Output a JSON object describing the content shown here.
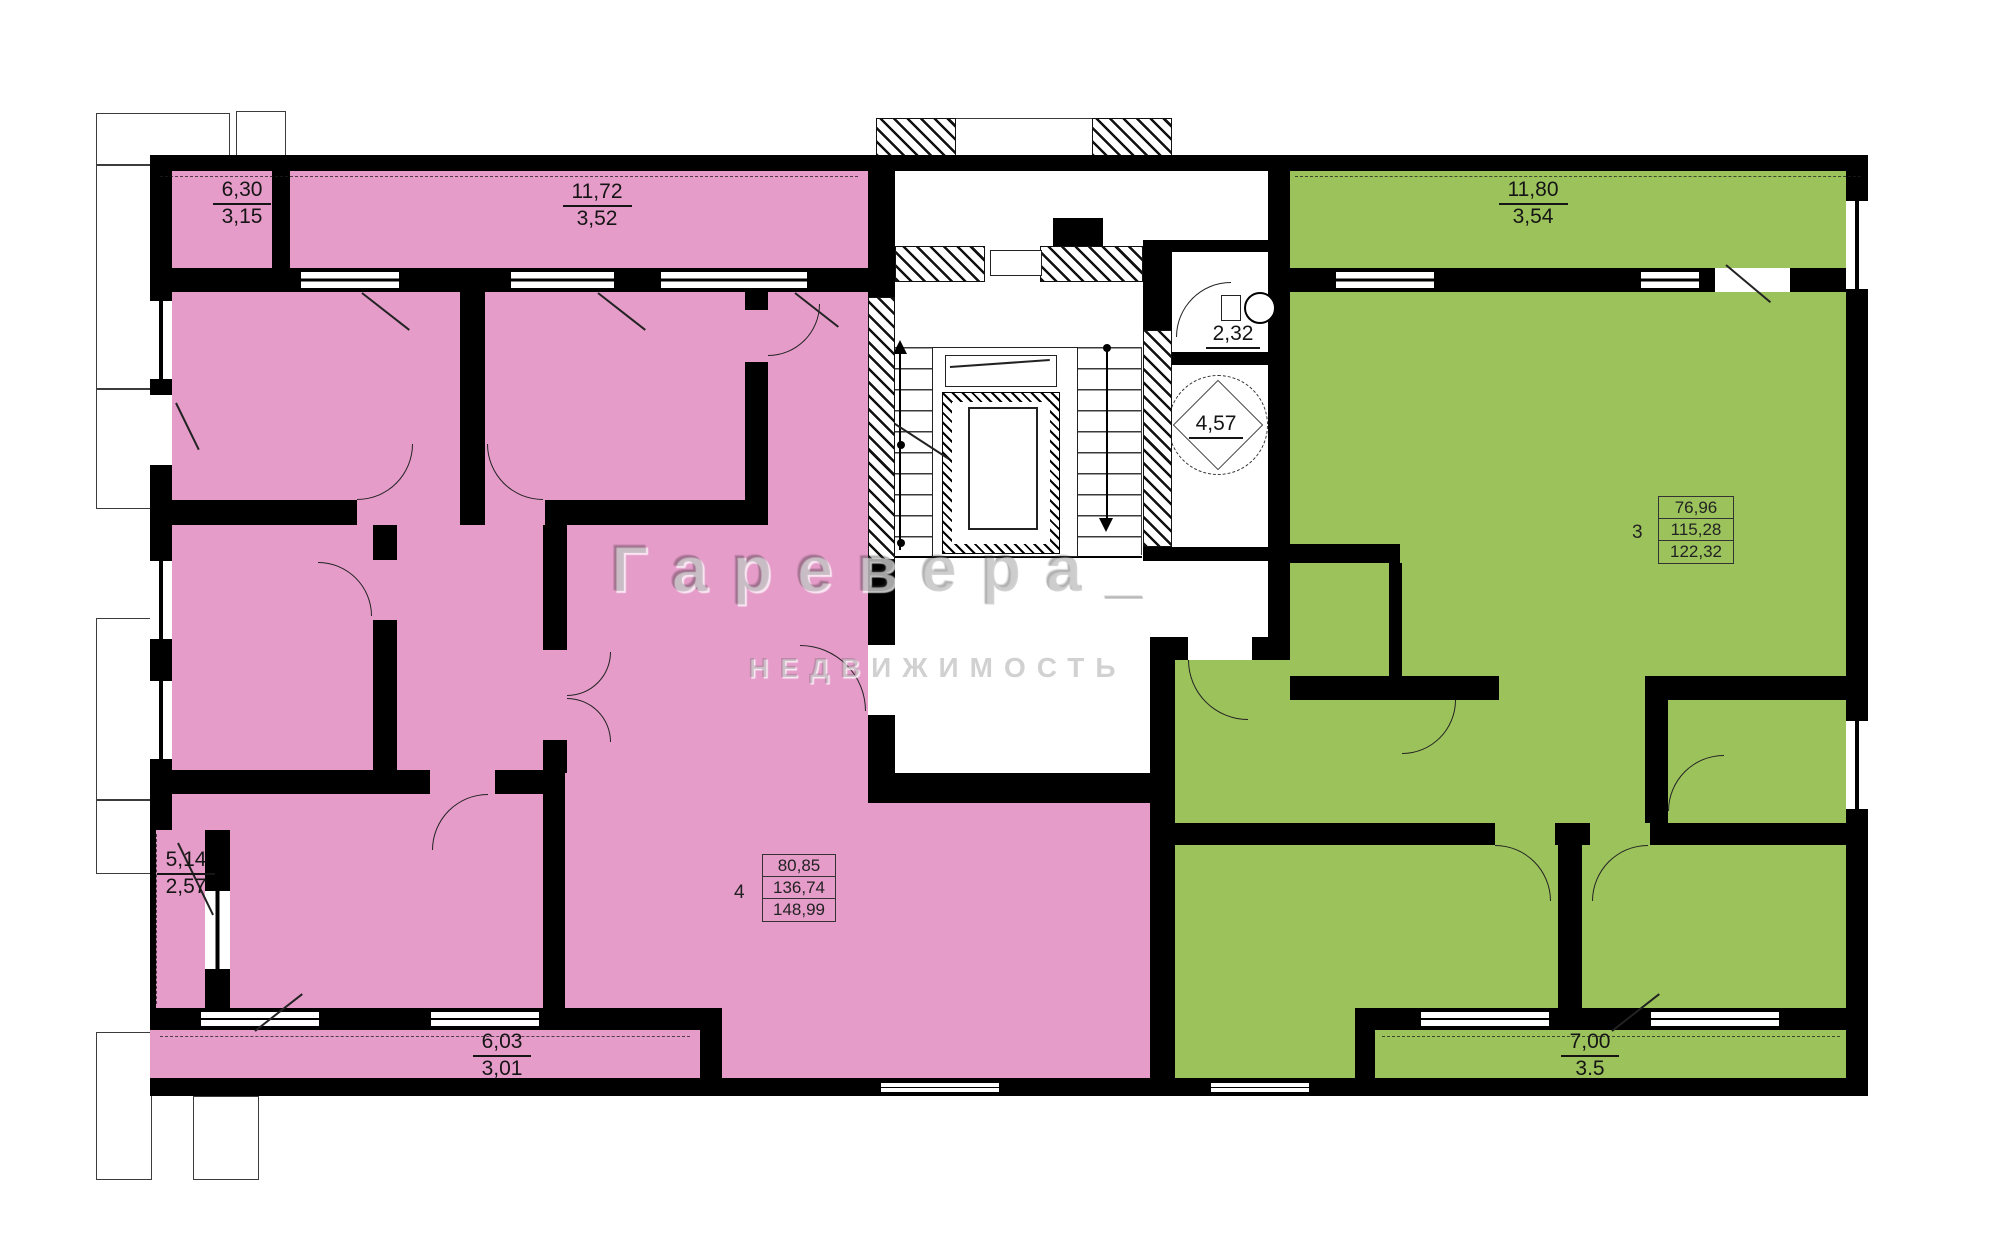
{
  "colors": {
    "apartment4_fill": "#E59CC9",
    "apartment3_fill": "#9CC25C",
    "wall": "#000000"
  },
  "watermark": {
    "brand": "Гаревера_",
    "subtitle": "НЕДВИЖИМОСТЬ"
  },
  "apartments": [
    {
      "id": "apartment-4",
      "room_count": "4",
      "areas": [
        "80,85",
        "136,74",
        "148,99"
      ]
    },
    {
      "id": "apartment-3",
      "room_count": "3",
      "areas": [
        "76,96",
        "115,28",
        "122,32"
      ]
    }
  ],
  "balconies": [
    {
      "id": "top-left",
      "area": "6,30",
      "reduced": "3,15"
    },
    {
      "id": "top-middle",
      "area": "11,72",
      "reduced": "3,52"
    },
    {
      "id": "top-right",
      "area": "11,80",
      "reduced": "3,54"
    },
    {
      "id": "left",
      "area": "5,14",
      "reduced": "2,57"
    },
    {
      "id": "bottom-left",
      "area": "6,03",
      "reduced": "3,01"
    },
    {
      "id": "bottom-right",
      "area": "7,00",
      "reduced": "3.5"
    }
  ],
  "common_rooms": {
    "refuse_chute": "2,32",
    "elevator": "4,57"
  }
}
